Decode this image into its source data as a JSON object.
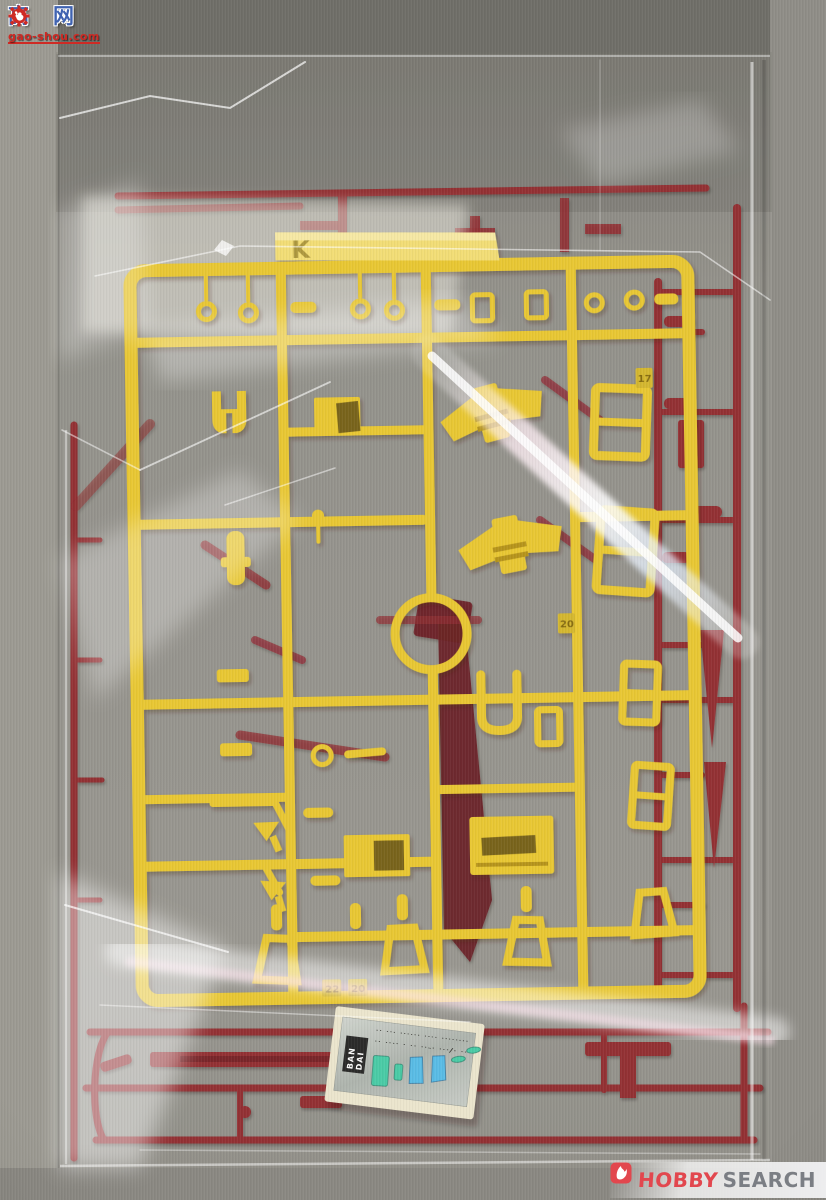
{
  "scene": {
    "alt": "Yellow and dark-red plastic model-kit runners sealed in a clear plastic bag with a foil sticker sheet"
  },
  "colors": {
    "bg": "#8d8b85",
    "bg_top": "#6f6e68",
    "bg_left": "#9c9a92",
    "bg_right": "#8f8d87",
    "bg_bottom": "#8a8882",
    "sprue_yellow": "#e9c526",
    "yellow_light": "#f4dd6e",
    "yellow_dark": "#b8940f",
    "sprue_red": "#8c2026",
    "red_dark": "#63131a",
    "red_light": "#a43238",
    "decal_silver": "#b9beb8",
    "decal_border": "#ece5cc",
    "sticker_green": "#3ec9a2",
    "sticker_blue": "#4fb9e6",
    "wm_blue": "#3f62b0",
    "wm_red": "#cf2a24",
    "hobby_red": "#e2474e",
    "hobby_gray": "#7b7e84"
  },
  "sprue_yellow": {
    "gate_letter": "K",
    "tags": [
      {
        "label": "17"
      },
      {
        "label": "22"
      },
      {
        "label": "20"
      },
      {
        "label": "20"
      }
    ]
  },
  "decal_sheet": {
    "brand_line1": "BAN",
    "brand_line2": "DAI",
    "fineprint_line1": "·· ··· ······ ···· ········",
    "fineprint_line2": "·· ···· · ·· ··-· ···/· ··"
  },
  "watermarks": {
    "gaoshou": {
      "char_left": "高",
      "char_right": "网",
      "url": "gao-shou.com"
    },
    "hobbysearch": {
      "word1": "HOBBY",
      "word2": "SEARCH"
    }
  }
}
